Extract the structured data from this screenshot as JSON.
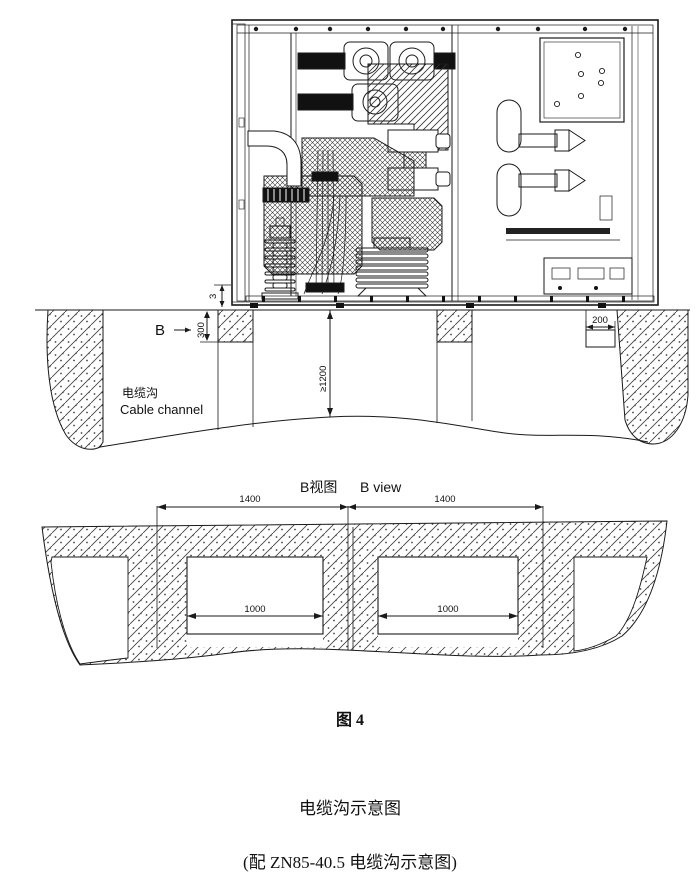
{
  "captions": {
    "figure_label": "图 4",
    "title_cn": "电缆沟示意图",
    "subtitle": "(配 ZN85-40.5  电缆沟示意图)"
  },
  "cross_section": {
    "view_marker": "B",
    "channel_label_cn": "电缆沟",
    "channel_label_en": "Cable channel",
    "dims": {
      "floor_gap": "3",
      "foundation_depth": "300",
      "trench_depth": "≥1200",
      "right_step": "200"
    }
  },
  "b_view": {
    "title_cn": "B视图",
    "title_en": "B view",
    "dims": {
      "pitch_left": "1400",
      "pitch_right": "1400",
      "opening_left": "1000",
      "opening_right": "1000"
    }
  },
  "colors": {
    "line": "#1a1a1a",
    "background": "#ffffff"
  }
}
